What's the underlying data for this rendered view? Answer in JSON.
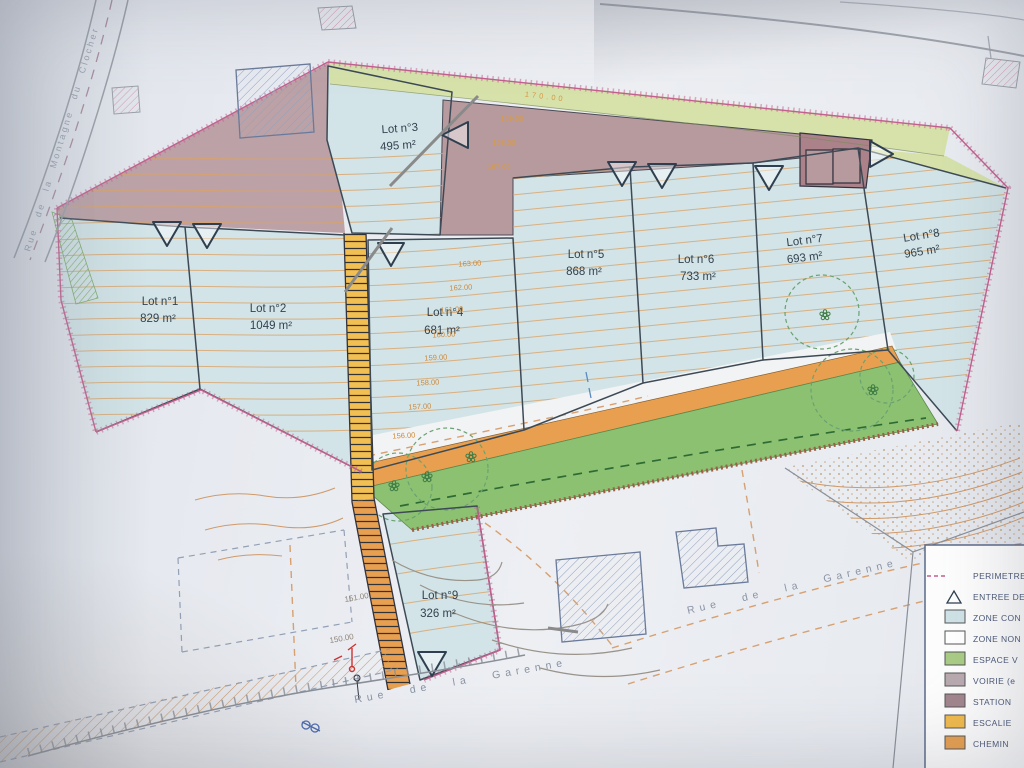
{
  "plan": {
    "lots": [
      {
        "name": "Lot n°1",
        "area": "829 m²"
      },
      {
        "name": "Lot n°2",
        "area": "1049 m²"
      },
      {
        "name": "Lot n°3",
        "area": "495 m²"
      },
      {
        "name": "Lot n°4",
        "area": "681 m²"
      },
      {
        "name": "Lot n°5",
        "area": "868 m²"
      },
      {
        "name": "Lot n°6",
        "area": "733 m²"
      },
      {
        "name": "Lot n°7",
        "area": "693 m²"
      },
      {
        "name": "Lot n°8",
        "area": "965 m²"
      },
      {
        "name": "Lot n°9",
        "area": "326 m²"
      }
    ],
    "streets": {
      "left": "Rue de la Montagne du Clocher",
      "bottom": "Rue de la Garenne",
      "right": "Rue de la Garenne"
    },
    "contours": {
      "upper": [
        "170.00",
        "169.00",
        "168.00",
        "167.00"
      ],
      "mid": [
        "163.00",
        "162.00",
        "161.00",
        "160.00",
        "159.00",
        "158.00",
        "157.00",
        "156.00"
      ],
      "lower": [
        "151.00",
        "150.00"
      ]
    },
    "legend": {
      "items": [
        {
          "label": "PERIMETRE",
          "symbol": "dashed-line",
          "color": "#c2608e"
        },
        {
          "label": "ENTREE DE",
          "symbol": "triangle",
          "color": "#ffffff"
        },
        {
          "label": "ZONE CON",
          "symbol": "swatch",
          "color": "#cfe3e7"
        },
        {
          "label": "ZONE NON",
          "symbol": "swatch",
          "color": "#ffffff"
        },
        {
          "label": "ESPACE V",
          "symbol": "swatch",
          "color": "#a9cc85"
        },
        {
          "label": "VOIRIE (e",
          "symbol": "swatch",
          "color": "#b9aab0"
        },
        {
          "label": "STATION",
          "symbol": "swatch",
          "color": "#a3868e"
        },
        {
          "label": "ESCALIE",
          "symbol": "swatch",
          "color": "#f2bb4c"
        },
        {
          "label": "CHEMIN",
          "symbol": "swatch",
          "color": "#e8a050"
        }
      ]
    },
    "colors": {
      "zone_constructible": "#d2e4e7",
      "espace_vert": "#8cc172",
      "espace_vert_bande": "#d6e2aa",
      "voirie": "#b79a9e",
      "stationnement": "#ab8289",
      "escalier": "#f2c052",
      "chemin": "#e8a050",
      "perimetre": "#c2608e"
    }
  }
}
